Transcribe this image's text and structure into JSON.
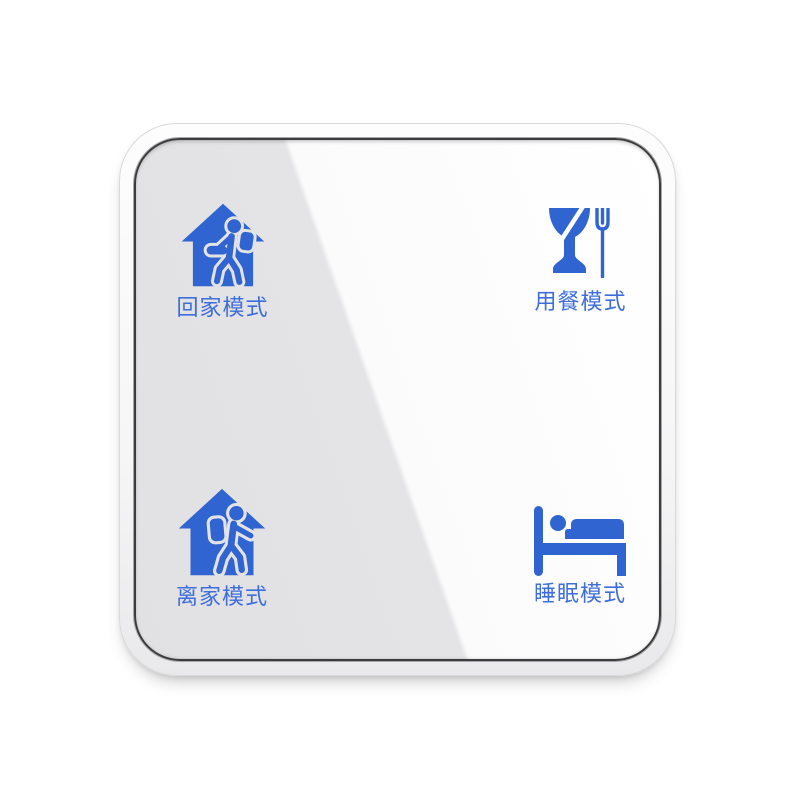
{
  "device": {
    "kind": "wall-mounted scene switch panel",
    "face_style": "glass with diagonal reflection"
  },
  "colors": {
    "page_background": "#FFFFFF",
    "icon_blue": "#3064D0",
    "label_blue": "#3E6EDC",
    "glass_gray": "#E3E3E5",
    "glass_highlight": "#FFFFFF",
    "bezel_line": "#3C3C3E",
    "frame_white": "#F6F6F7"
  },
  "buttons": [
    {
      "id": "home",
      "label": "回家模式",
      "icon": "house-person-entering-icon"
    },
    {
      "id": "dining",
      "label": "用餐模式",
      "icon": "glass-fork-icon"
    },
    {
      "id": "away",
      "label": "离家模式",
      "icon": "house-person-leaving-icon"
    },
    {
      "id": "sleep",
      "label": "睡眠模式",
      "icon": "bed-sleep-icon"
    }
  ]
}
